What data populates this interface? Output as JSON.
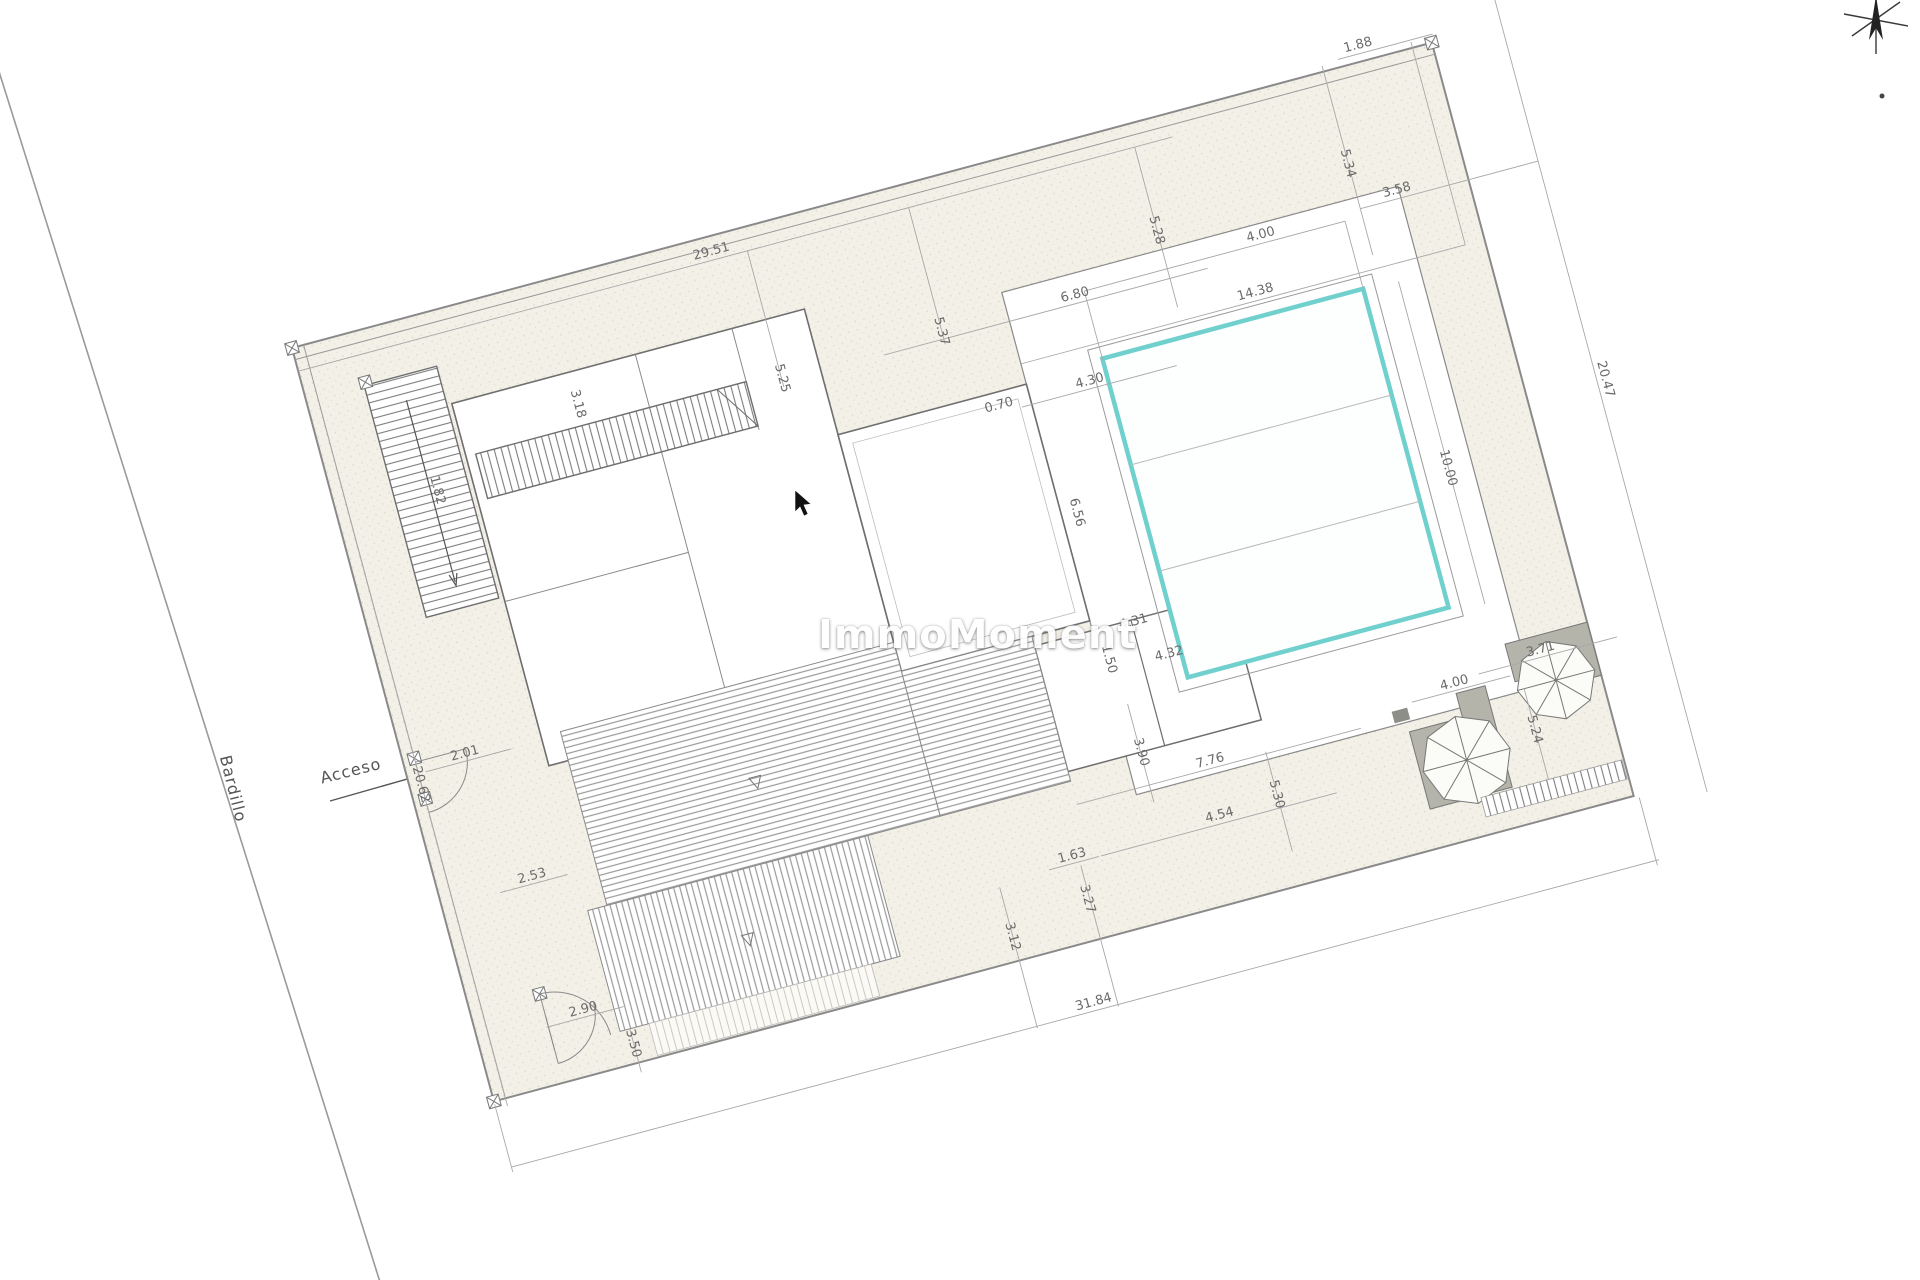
{
  "labels": {
    "street_name": "Bardillo",
    "access": "Acceso",
    "watermark": "ImmoMoment"
  },
  "colors": {
    "pool_border": "#6fd0cd",
    "ground": "#f2f0e7",
    "wall_line": "#6e6e6e",
    "thin_line": "#9a9a9a",
    "dim_text": "#6a6a6a",
    "platform_fill": "#b5b4aa"
  },
  "dims": [
    {
      "v": "29.51"
    },
    {
      "v": "1.88"
    },
    {
      "v": "20.47"
    },
    {
      "v": "31.84"
    },
    {
      "v": "20.62"
    },
    {
      "v": "1.82"
    },
    {
      "v": "2.01"
    },
    {
      "v": "2.53"
    },
    {
      "v": "2.90"
    },
    {
      "v": "3.50"
    },
    {
      "v": "3.18"
    },
    {
      "v": "5.25"
    },
    {
      "v": "5.37"
    },
    {
      "v": "5.28"
    },
    {
      "v": "5.34"
    },
    {
      "v": "3.58"
    },
    {
      "v": "4.00"
    },
    {
      "v": "14.38"
    },
    {
      "v": "6.80"
    },
    {
      "v": "0.70"
    },
    {
      "v": "4.30"
    },
    {
      "v": "6.56"
    },
    {
      "v": "10.00"
    },
    {
      "v": "4.31"
    },
    {
      "v": "4.32"
    },
    {
      "v": "1.50"
    },
    {
      "v": "3.90"
    },
    {
      "v": "7.76"
    },
    {
      "v": "4.54"
    },
    {
      "v": "1.63"
    },
    {
      "v": "5.30"
    },
    {
      "v": "3.27"
    },
    {
      "v": "3.12"
    },
    {
      "v": "4.00"
    },
    {
      "v": "3.71"
    },
    {
      "v": "5.24"
    }
  ]
}
